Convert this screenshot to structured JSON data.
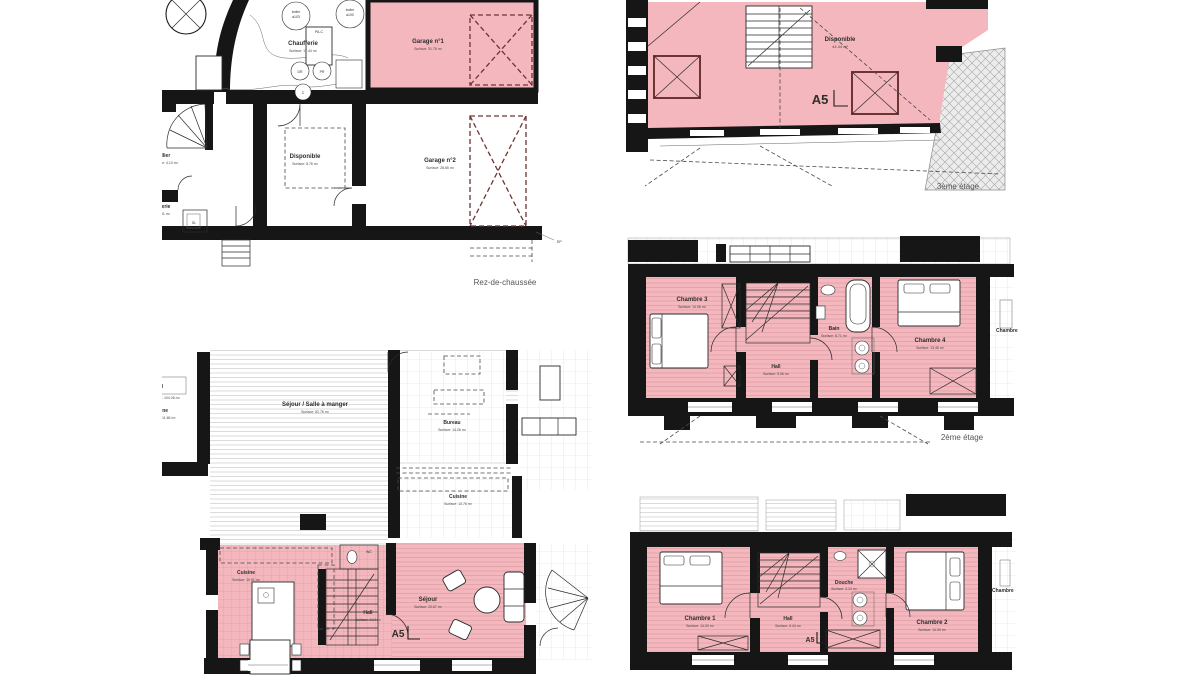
{
  "colors": {
    "pink": "#f3b7bd",
    "wall": "#161616",
    "dash_red": "#6e3434",
    "label_ink": "#2e2e2e",
    "floor_ink": "#555555"
  },
  "floors": {
    "rdc": {
      "label": "Rez-de-chaussée",
      "chaufferie": {
        "name": "Chaufferie",
        "surface": "Surface: 17.44 m²"
      },
      "garage1": {
        "name": "Garage n°1",
        "surface": "Surface: 31.76 m²"
      },
      "garage2": {
        "name": "Garage n°2",
        "surface": "Surface: 28.65 m²"
      },
      "disponible": {
        "name": "Disponible",
        "surface": "Surface: 8.76 m²"
      },
      "cellier": {
        "name": "Cellier",
        "surface": "Surface: 4.10 m²"
      },
      "buanderie": {
        "name": "Buanderie",
        "surface": "Surface: 6.31 m²"
      },
      "boiler1_l1": "boiler",
      "boiler1_l2": "a103",
      "boiler2_l1": "boiler",
      "boiler2_l2": "a100",
      "pac": "PA-C",
      "dr": "DR",
      "pr": "PR",
      "c": "C",
      "sl": "SL",
      "ep": "EP"
    },
    "etage3": {
      "label": "3ème étage",
      "unit": "A5",
      "disponible": {
        "name": "Disponible",
        "surface": "44.44 m²"
      }
    },
    "etage2": {
      "label": "2ème étage",
      "chambre3": {
        "name": "Chambre 3",
        "surface": "Surface: 14.06 m²"
      },
      "hall": {
        "name": "Hall",
        "surface": "Surface: 5.06 m²"
      },
      "bain": {
        "name": "Bain",
        "surface": "Surface: 8.71 m²"
      },
      "chambre4": {
        "name": "Chambre 4",
        "surface": "Surface: 13.46 m²"
      },
      "partial_room": "Chambre"
    },
    "etage1_jour": {
      "a03": {
        "name": "A03",
        "surface": "Surface: 104.26 m²"
      },
      "cuisine_a03": {
        "name": "Cuisine",
        "surface": "Surface: 11.65 m²"
      },
      "sejour_sam": {
        "name": "Séjour / Salle à manger",
        "surface": "Surface: 52.76 m²"
      },
      "bureau": {
        "name": "Bureau",
        "surface": "Surface: 14.26 m²"
      },
      "cuisine": {
        "name": "Cuisine",
        "surface": "Surface: 13.76 m²"
      },
      "cuisine_a5": {
        "name": "Cuisine",
        "surface": "Surface: 10.91 m²"
      },
      "wc": "WC",
      "hall": {
        "name": "Hall",
        "surface": "Surface: 4.14 m²"
      },
      "sejour": {
        "name": "Séjour",
        "surface": "Surface: 20.67 m²"
      },
      "unit": "A5"
    },
    "etage1_nuit": {
      "chambre1": {
        "name": "Chambre 1",
        "surface": "Surface: 14.03 m²"
      },
      "hall": {
        "name": "Hall",
        "surface": "Surface: 6.44 m²"
      },
      "douche": {
        "name": "Douche",
        "surface": "Surface: 3.13 m²"
      },
      "chambre2": {
        "name": "Chambre 2",
        "surface": "Surface: 14.03 m²"
      },
      "partial_room": "Chambre",
      "unit": "A5"
    }
  }
}
